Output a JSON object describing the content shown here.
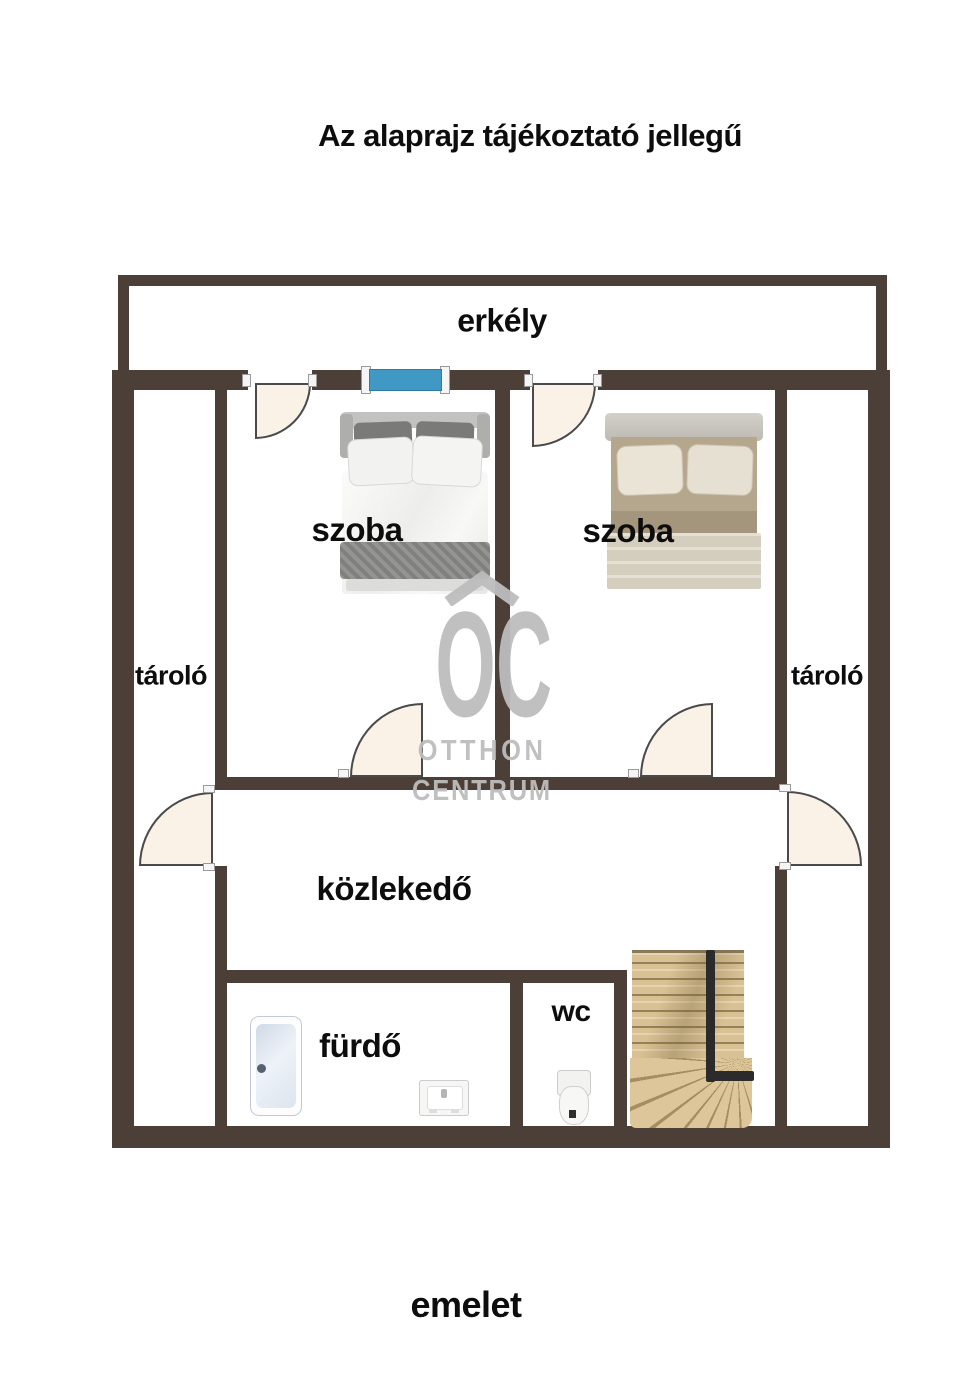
{
  "title": "Az alaprajz tájékoztató jellegű",
  "floor_label": "emelet",
  "rooms": {
    "balcony": "erkély",
    "room1": "szoba",
    "room2": "szoba",
    "storage_left": "tároló",
    "storage_right": "tároló",
    "hallway": "közlekedő",
    "bathroom": "fürdő",
    "wc": "wc"
  },
  "watermark": {
    "initials": "OC",
    "line1": "OTTHON",
    "line2": "CENTRUM"
  },
  "colors": {
    "wall": "#4b3f37",
    "door_leaf": "#faf1e7",
    "door_outline": "#4a4a4a",
    "window_glass": "#3f99c4",
    "watermark_gray": "#bdbdbd",
    "stairs_wood": "#d9c193",
    "label_text": "#0d0d0d"
  }
}
